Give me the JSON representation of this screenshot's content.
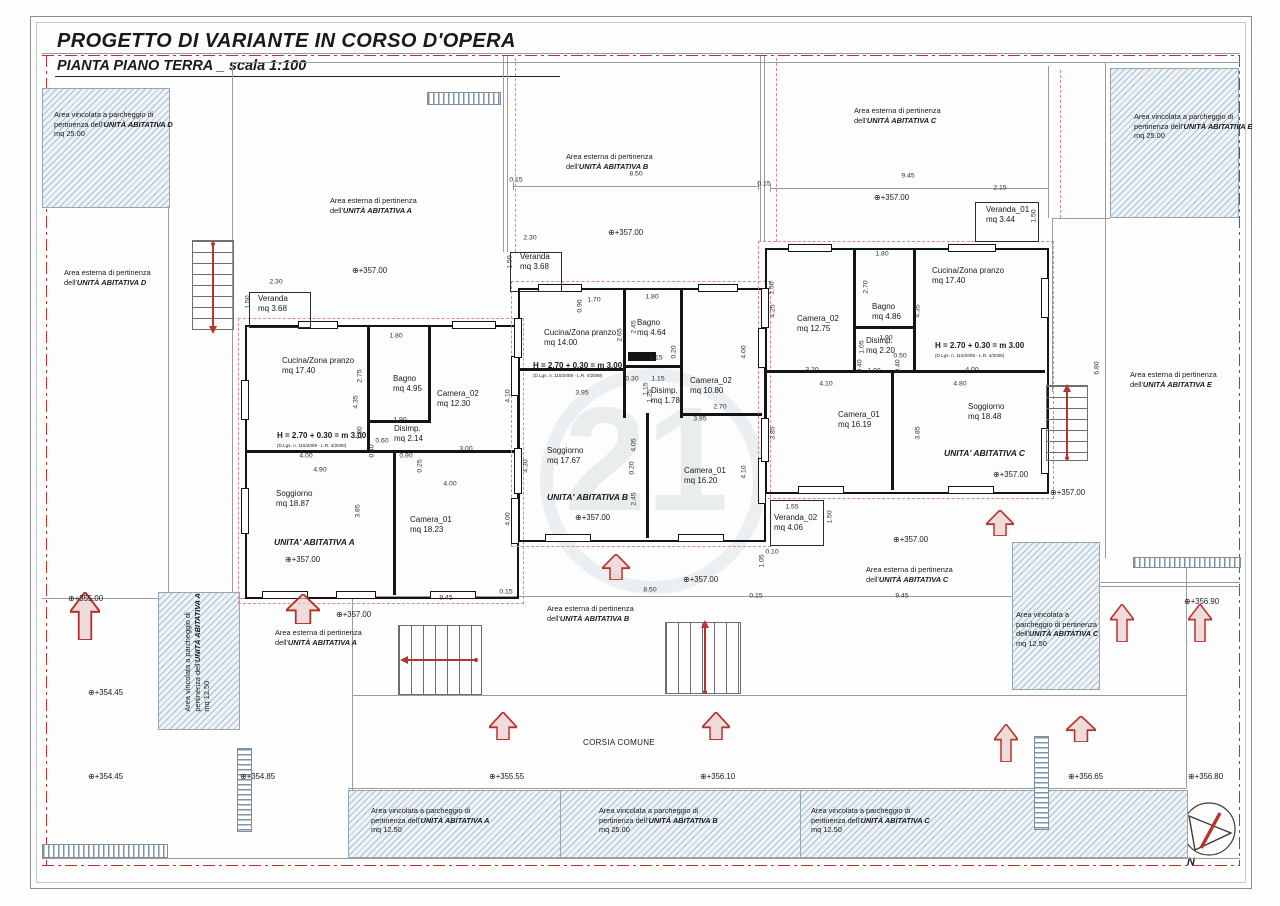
{
  "title": {
    "line1": "PROGETTO DI VARIANTE IN CORSO D'OPERA",
    "line2": "PIANTA PIANO TERRA _ scala 1:100"
  },
  "colors": {
    "boundary_red": "#b5342e",
    "wall_black": "#141414",
    "hatch_blue": "#93a7b8",
    "pink_dashed": "#d98a8a"
  },
  "watermark": "21",
  "compass_label": "N",
  "corsia_label": "CORSIA COMUNE",
  "height_note": "H = 2.70 + 0.30 = m 3.00",
  "height_law": "(D.Lgs. n. 115/2008 - L.R. 4/2009)",
  "units": [
    {
      "name": "UNITA' ABITATIVA A",
      "name_x": 274,
      "name_y": 537,
      "hnote_x": 277,
      "hnote_y": 431,
      "law_x": 277,
      "law_y": 443,
      "rooms": [
        {
          "label": "Cucina/Zona pranzo",
          "area": "mq 17.40",
          "x": 282,
          "y": 356
        },
        {
          "label": "Bagno",
          "area": "mq 4.95",
          "x": 393,
          "y": 374
        },
        {
          "label": "Camera_02",
          "area": "mq 12.30",
          "x": 437,
          "y": 389
        },
        {
          "label": "Disimp.",
          "area": "mq 2.14",
          "x": 394,
          "y": 424
        },
        {
          "label": "Soggiorno",
          "area": "mq 18.87",
          "x": 276,
          "y": 489
        },
        {
          "label": "Camera_01",
          "area": "mq 18.23",
          "x": 410,
          "y": 515
        }
      ]
    },
    {
      "name": "UNITA' ABITATIVA B",
      "name_x": 547,
      "name_y": 492,
      "hnote_x": 533,
      "hnote_y": 361,
      "law_x": 533,
      "law_y": 373,
      "rooms": [
        {
          "label": "Cucina/Zona pranzo",
          "area": "mq 14.00",
          "x": 544,
          "y": 328
        },
        {
          "label": "Bagno",
          "area": "mq 4.64",
          "x": 637,
          "y": 318
        },
        {
          "label": "Camera_02",
          "area": "mq 10.80",
          "x": 690,
          "y": 376
        },
        {
          "label": "Disimp.",
          "area": "mq 1.78",
          "x": 651,
          "y": 386
        },
        {
          "label": "Soggiorno",
          "area": "mq 17.67",
          "x": 547,
          "y": 446
        },
        {
          "label": "Camera_01",
          "area": "mq 16.20",
          "x": 684,
          "y": 466
        }
      ]
    },
    {
      "name": "UNITA' ABITATIVA C",
      "name_x": 944,
      "name_y": 448,
      "hnote_x": 935,
      "hnote_y": 341,
      "law_x": 935,
      "law_y": 353,
      "rooms": [
        {
          "label": "Camera_02",
          "area": "mq 12.75",
          "x": 797,
          "y": 314
        },
        {
          "label": "Bagno",
          "area": "mq 4.86",
          "x": 872,
          "y": 302
        },
        {
          "label": "Cucina/Zona pranzo",
          "area": "mq 17.40",
          "x": 932,
          "y": 266
        },
        {
          "label": "Disimp.",
          "area": "mq 2.20",
          "x": 866,
          "y": 336
        },
        {
          "label": "Camera_01",
          "area": "mq 16.19",
          "x": 838,
          "y": 410
        },
        {
          "label": "Soggiorno",
          "area": "mq 18.48",
          "x": 968,
          "y": 402
        }
      ]
    }
  ],
  "verandas": [
    {
      "label": "Veranda",
      "area": "mq 3.68",
      "x": 258,
      "y": 294
    },
    {
      "label": "Veranda",
      "area": "mq 3.68",
      "x": 520,
      "y": 252
    },
    {
      "label": "Veranda_01",
      "area": "mq 3.44",
      "x": 986,
      "y": 205
    },
    {
      "label": "Veranda_02",
      "area": "mq 4.06",
      "x": 774,
      "y": 513
    }
  ],
  "area_labels": [
    {
      "x": 54,
      "y": 110,
      "lines": [
        [
          "Area vincolata a parcheggio di"
        ],
        [
          "pertinenza dell'",
          "UNITÀ ABITATIVA D"
        ],
        [
          "mq 25.00"
        ]
      ]
    },
    {
      "x": 1134,
      "y": 112,
      "lines": [
        [
          "Area vincolata a parcheggio di"
        ],
        [
          "pertinenza dell'",
          "UNITÀ ABITATIVA E"
        ],
        [
          "mq 25.00"
        ]
      ]
    },
    {
      "x": 64,
      "y": 268,
      "lines": [
        [
          "Area esterna di pertinenza"
        ],
        [
          "dell'",
          "UNITÀ ABITATIVA D"
        ]
      ]
    },
    {
      "x": 330,
      "y": 196,
      "lines": [
        [
          "Area esterna di pertinenza"
        ],
        [
          "dell'",
          "UNITÀ ABITATIVA A"
        ]
      ]
    },
    {
      "x": 566,
      "y": 152,
      "lines": [
        [
          "Area esterna di pertinenza"
        ],
        [
          "dell'",
          "UNITÀ ABITATIVA B"
        ]
      ]
    },
    {
      "x": 854,
      "y": 106,
      "lines": [
        [
          "Area esterna di pertinenza"
        ],
        [
          "dell'",
          "UNITÀ ABITATIVA C"
        ]
      ]
    },
    {
      "x": 1130,
      "y": 370,
      "lines": [
        [
          "Area esterna di pertinenza"
        ],
        [
          "dell'",
          "UNITÀ ABITATIVA E"
        ]
      ]
    },
    {
      "x": 275,
      "y": 628,
      "lines": [
        [
          "Area esterna di pertinenza"
        ],
        [
          "dell'",
          "UNITÀ ABITATIVA A"
        ]
      ]
    },
    {
      "x": 547,
      "y": 604,
      "lines": [
        [
          "Area esterna di pertinenza"
        ],
        [
          "dell'",
          "UNITÀ ABITATIVA B"
        ]
      ]
    },
    {
      "x": 866,
      "y": 565,
      "lines": [
        [
          "Area esterna di pertinenza"
        ],
        [
          "dell'",
          "UNITÀ ABITATIVA C"
        ]
      ]
    },
    {
      "x": 138,
      "y": 638,
      "rot": -90,
      "lines": [
        [
          "Area vincolata a parcheggio di"
        ],
        [
          "pertinenza dell'",
          "UNITÀ ABITATIVA A"
        ],
        [
          "mq 12.50"
        ]
      ]
    },
    {
      "x": 1016,
      "y": 610,
      "lines": [
        [
          "Area vincolata a"
        ],
        [
          "parcheggio di pertinenza"
        ],
        [
          "dell'",
          "UNITÀ ABITATIVA C"
        ],
        [
          "mq 12.50"
        ]
      ]
    },
    {
      "x": 371,
      "y": 806,
      "lines": [
        [
          "Area vincolata a parcheggio di"
        ],
        [
          "pertinenza dell'",
          "UNITÀ ABITATIVA A"
        ],
        [
          "mq 12.50"
        ]
      ]
    },
    {
      "x": 599,
      "y": 806,
      "lines": [
        [
          "Area vincolata a parcheggio di"
        ],
        [
          "pertinenza dell'",
          "UNITÀ ABITATIVA B"
        ],
        [
          "mq 25.00"
        ]
      ]
    },
    {
      "x": 811,
      "y": 806,
      "lines": [
        [
          "Area vincolata a parcheggio di"
        ],
        [
          "pertinenza dell'",
          "UNITÀ ABITATIVA C"
        ],
        [
          "mq 12.50"
        ]
      ]
    }
  ],
  "elevations": [
    {
      "v": "+355.00",
      "x": 68,
      "y": 594
    },
    {
      "v": "+354.45",
      "x": 88,
      "y": 688
    },
    {
      "v": "+354.45",
      "x": 88,
      "y": 772
    },
    {
      "v": "+354.85",
      "x": 240,
      "y": 772
    },
    {
      "v": "+355.55",
      "x": 489,
      "y": 772
    },
    {
      "v": "+356.10",
      "x": 700,
      "y": 772
    },
    {
      "v": "+356.65",
      "x": 1068,
      "y": 772
    },
    {
      "v": "+356.80",
      "x": 1188,
      "y": 772
    },
    {
      "v": "+356.90",
      "x": 1184,
      "y": 597
    },
    {
      "v": "+357.00",
      "x": 352,
      "y": 266
    },
    {
      "v": "+357.00",
      "x": 608,
      "y": 228
    },
    {
      "v": "+357.00",
      "x": 874,
      "y": 193
    },
    {
      "v": "+357.00",
      "x": 285,
      "y": 555
    },
    {
      "v": "+357.00",
      "x": 575,
      "y": 513
    },
    {
      "v": "+357.00",
      "x": 993,
      "y": 470
    },
    {
      "v": "+357.00",
      "x": 683,
      "y": 575
    },
    {
      "v": "+357.00",
      "x": 893,
      "y": 535
    },
    {
      "v": "+357.00",
      "x": 1050,
      "y": 488
    },
    {
      "v": "+357.00",
      "x": 336,
      "y": 610
    }
  ],
  "dimensions": [
    {
      "t": "0.15",
      "x": 516,
      "y": 180
    },
    {
      "t": "8.50",
      "x": 636,
      "y": 174
    },
    {
      "t": "0.15",
      "x": 764,
      "y": 184
    },
    {
      "t": "9.45",
      "x": 908,
      "y": 176
    },
    {
      "t": "2.15",
      "x": 1000,
      "y": 188
    },
    {
      "t": "2.30",
      "x": 276,
      "y": 282
    },
    {
      "t": "1.50",
      "x": 248,
      "y": 302,
      "v": 1
    },
    {
      "t": "2.30",
      "x": 530,
      "y": 238
    },
    {
      "t": "1.50",
      "x": 510,
      "y": 262,
      "v": 1
    },
    {
      "t": "1.50",
      "x": 772,
      "y": 288,
      "v": 1
    },
    {
      "t": "1.50",
      "x": 1034,
      "y": 216,
      "v": 1
    },
    {
      "t": "1.80",
      "x": 396,
      "y": 336
    },
    {
      "t": "2.75",
      "x": 360,
      "y": 376,
      "v": 1
    },
    {
      "t": "4.35",
      "x": 356,
      "y": 402,
      "v": 1
    },
    {
      "t": "1.90",
      "x": 400,
      "y": 420
    },
    {
      "t": "1.00",
      "x": 360,
      "y": 433,
      "v": 1
    },
    {
      "t": "0.60",
      "x": 382,
      "y": 441
    },
    {
      "t": "0.40",
      "x": 372,
      "y": 451,
      "v": 1
    },
    {
      "t": "0.90",
      "x": 406,
      "y": 456
    },
    {
      "t": "3.00",
      "x": 466,
      "y": 449
    },
    {
      "t": "4.10",
      "x": 508,
      "y": 396,
      "v": 1
    },
    {
      "t": "0.25",
      "x": 420,
      "y": 466,
      "v": 1
    },
    {
      "t": "4.00",
      "x": 306,
      "y": 456
    },
    {
      "t": "4.90",
      "x": 320,
      "y": 470
    },
    {
      "t": "3.85",
      "x": 358,
      "y": 511,
      "v": 1
    },
    {
      "t": "4.00",
      "x": 450,
      "y": 484
    },
    {
      "t": "4.00",
      "x": 508,
      "y": 519,
      "v": 1
    },
    {
      "t": "9.45",
      "x": 446,
      "y": 598
    },
    {
      "t": "1.70",
      "x": 594,
      "y": 300
    },
    {
      "t": "0.90",
      "x": 580,
      "y": 306,
      "v": 1
    },
    {
      "t": "1.80",
      "x": 652,
      "y": 297
    },
    {
      "t": "2.45",
      "x": 634,
      "y": 327,
      "v": 1
    },
    {
      "t": "2.65",
      "x": 620,
      "y": 335,
      "v": 1
    },
    {
      "t": "1.15",
      "x": 656,
      "y": 358
    },
    {
      "t": "0.20",
      "x": 674,
      "y": 352,
      "v": 1
    },
    {
      "t": "0.30",
      "x": 632,
      "y": 379
    },
    {
      "t": "1.15",
      "x": 658,
      "y": 379
    },
    {
      "t": "1.15",
      "x": 646,
      "y": 389,
      "v": 1
    },
    {
      "t": "1.25",
      "x": 650,
      "y": 396,
      "v": 1
    },
    {
      "t": "3.95",
      "x": 582,
      "y": 393
    },
    {
      "t": "4.30",
      "x": 526,
      "y": 466,
      "v": 1
    },
    {
      "t": "0.20",
      "x": 632,
      "y": 468,
      "v": 1
    },
    {
      "t": "4.05",
      "x": 634,
      "y": 445,
      "v": 1
    },
    {
      "t": "2.45",
      "x": 634,
      "y": 499,
      "v": 1
    },
    {
      "t": "4.00",
      "x": 744,
      "y": 352,
      "v": 1
    },
    {
      "t": "2.70",
      "x": 720,
      "y": 407
    },
    {
      "t": "3.95",
      "x": 700,
      "y": 419
    },
    {
      "t": "4.10",
      "x": 744,
      "y": 472,
      "v": 1
    },
    {
      "t": "8.50",
      "x": 650,
      "y": 590
    },
    {
      "t": "0.15",
      "x": 506,
      "y": 592
    },
    {
      "t": "1.80",
      "x": 882,
      "y": 254
    },
    {
      "t": "2.70",
      "x": 866,
      "y": 287,
      "v": 1
    },
    {
      "t": "4.25",
      "x": 773,
      "y": 311,
      "v": 1
    },
    {
      "t": "4.35",
      "x": 918,
      "y": 311,
      "v": 1
    },
    {
      "t": "1.90",
      "x": 886,
      "y": 338
    },
    {
      "t": "1.05",
      "x": 862,
      "y": 347,
      "v": 1
    },
    {
      "t": "0.50",
      "x": 900,
      "y": 356
    },
    {
      "t": "1.00",
      "x": 874,
      "y": 371
    },
    {
      "t": "0.40",
      "x": 860,
      "y": 366,
      "v": 1
    },
    {
      "t": "0.40",
      "x": 898,
      "y": 366,
      "v": 1
    },
    {
      "t": "3.20",
      "x": 812,
      "y": 370
    },
    {
      "t": "4.00",
      "x": 972,
      "y": 370
    },
    {
      "t": "4.10",
      "x": 826,
      "y": 384
    },
    {
      "t": "4.80",
      "x": 960,
      "y": 384
    },
    {
      "t": "3.85",
      "x": 773,
      "y": 433,
      "v": 1
    },
    {
      "t": "3.85",
      "x": 918,
      "y": 433,
      "v": 1
    },
    {
      "t": "1.55",
      "x": 792,
      "y": 507
    },
    {
      "t": "1.50",
      "x": 830,
      "y": 517,
      "v": 1
    },
    {
      "t": "0.10",
      "x": 772,
      "y": 552
    },
    {
      "t": "1.05",
      "x": 762,
      "y": 561,
      "v": 1
    },
    {
      "t": "0.15",
      "x": 756,
      "y": 596
    },
    {
      "t": "9.45",
      "x": 902,
      "y": 596
    },
    {
      "t": "6.80",
      "x": 1097,
      "y": 368,
      "v": 1
    }
  ]
}
